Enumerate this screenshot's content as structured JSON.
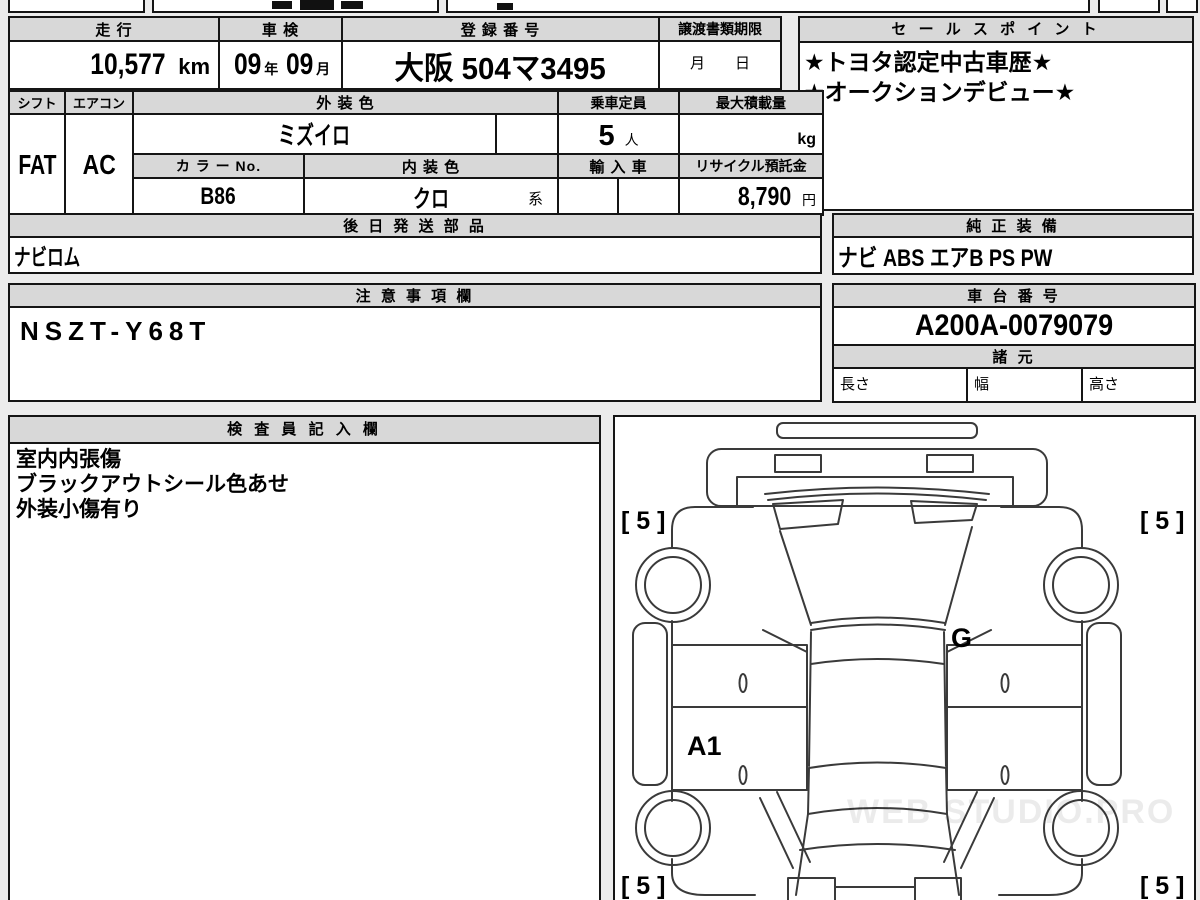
{
  "colors": {
    "border": "#151515",
    "header_bg": "#d8d8d8",
    "page_bg": "#ececec",
    "diagram_line": "#3a3a3a"
  },
  "row1": {
    "mileage_label": "走 行",
    "mileage_value": "10,577",
    "mileage_unit": "km",
    "inspection_label": "車 検",
    "inspection_year": "09",
    "inspection_year_unit": "年",
    "inspection_month": "09",
    "inspection_month_unit": "月",
    "registration_label": "登 録 番 号",
    "registration_value": "大阪 504マ3495",
    "transfer_label": "譲渡書類期限",
    "transfer_month": "月",
    "transfer_day": "日"
  },
  "sales_point": {
    "label": "セ ー ル ス ポ イ ン ト",
    "line1": "★トヨタ認定中古車歴★",
    "line2": "★オークションデビュー★"
  },
  "row2": {
    "shift_label": "シフト",
    "shift_value": "FAT",
    "aircon_label": "エアコン",
    "aircon_value": "AC",
    "exterior_label": "外 装 色",
    "exterior_value": "ミズイロ",
    "capacity_label": "乗車定員",
    "capacity_value": "5",
    "capacity_unit": "人",
    "load_label": "最大積載量",
    "load_unit": "kg",
    "colorno_label": "カ ラ ー No.",
    "colorno_value": "B86",
    "interior_label": "内 装 色",
    "interior_value": "クロ",
    "interior_suffix": "系",
    "import_label": "輸 入 車",
    "recycle_label": "リサイクル預託金",
    "recycle_value": "8,790",
    "recycle_unit": "円"
  },
  "later_parts": {
    "label": "後 日 発 送 部 品",
    "value": "ナビロム"
  },
  "equipment": {
    "label": "純 正 装 備",
    "value": "ナビ ABS エアB PS PW"
  },
  "notes": {
    "label": "注 意 事 項 欄",
    "value": "NSZT-Y68T"
  },
  "chassis": {
    "label": "車 台 番 号",
    "value": "A200A-0079079"
  },
  "specs": {
    "label": "諸 元",
    "length_label": "長さ",
    "width_label": "幅",
    "height_label": "高さ"
  },
  "inspector": {
    "label": "検 査 員 記 入 欄",
    "line1": "室内内張傷",
    "line2": "ブラックアウトシール色あせ",
    "line3": "外装小傷有り"
  },
  "diagram": {
    "tire_front_left": "[ 5 ]",
    "tire_front_right": "[ 5 ]",
    "tire_rear_left": "[ 5 ]",
    "tire_rear_right": "[ 5 ]",
    "label_g": "G",
    "label_a1": "A1",
    "watermark": "WEB STUDIO.PRO"
  }
}
